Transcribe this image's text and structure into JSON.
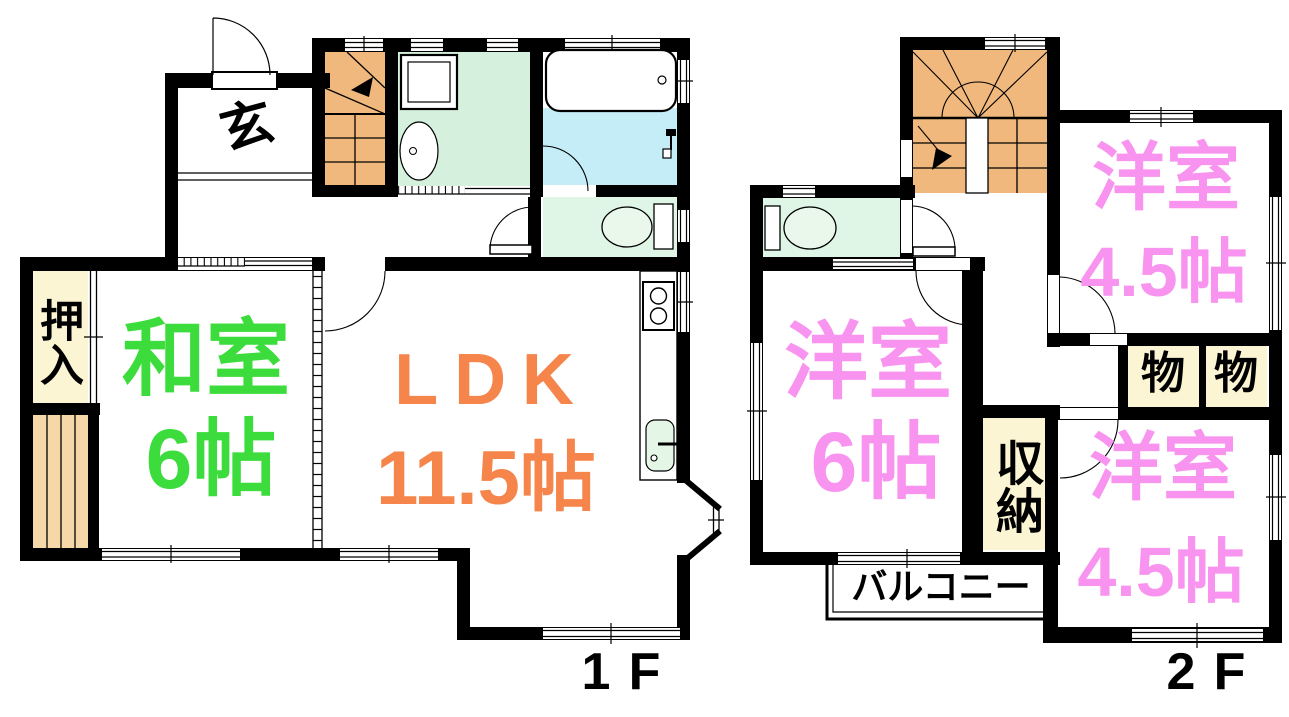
{
  "floor1": {
    "floor_label": "1F",
    "entrance_label": "玄",
    "closet_label": "押入",
    "japanese_room": {
      "name": "和室",
      "size": "6帖"
    },
    "ldk": {
      "name": "LDK",
      "size": "11.5帖"
    }
  },
  "floor2": {
    "floor_label": "2F",
    "western_room_6": {
      "name": "洋室",
      "size": "6帖"
    },
    "western_room_45_upper": {
      "name": "洋室",
      "size": "4.5帖"
    },
    "western_room_45_lower": {
      "name": "洋室",
      "size": "4.5帖"
    },
    "storage_label": "収納",
    "storage_small_left": "物",
    "storage_small_right": "物",
    "balcony_label": "バルコニー"
  },
  "colors": {
    "wall": "#000000",
    "text": "#000000",
    "stairs_fill": "#F0B87C",
    "porch_fill": "#F6D8A8",
    "closet_fill": "#FBF5D3",
    "washroom_fill": "#D5F0DD",
    "bathroom_fill": "#C4EDF7",
    "toilet_fill": "#DFF5E5",
    "toilet_bowl_fill": "#EAF8EC",
    "sink_fill": "#E4F7E6",
    "japanese_room_label": "#3BDC3B",
    "ldk_label": "#F5854A",
    "western_room_label": "#F893EF"
  }
}
